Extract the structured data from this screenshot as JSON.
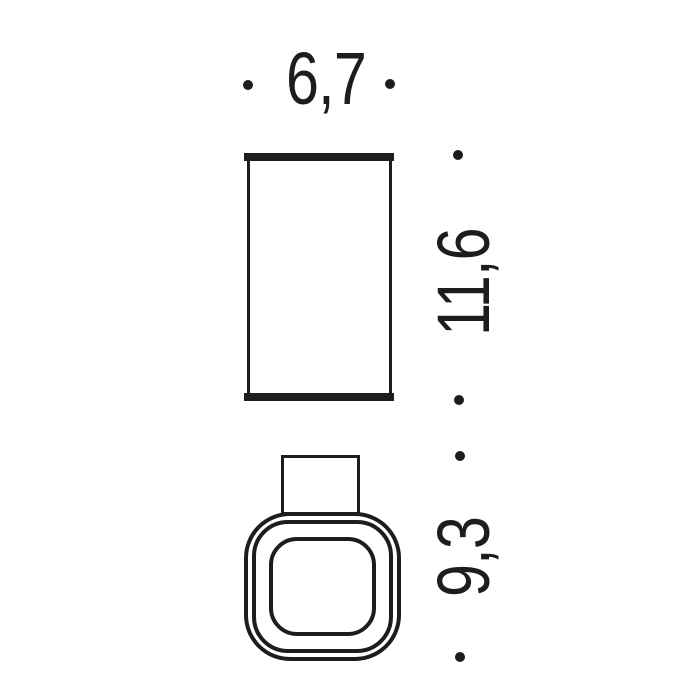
{
  "page": {
    "background_color": "#ffffff",
    "line_color": "#1d1d1b"
  },
  "drawing": {
    "type": "technical-dimension-drawing",
    "views": [
      {
        "name": "front-view",
        "shape": "rectangle with thick top and bottom rims"
      },
      {
        "name": "top-view",
        "shape": "rounded square with three concentric outlines and rectangular neck"
      }
    ],
    "dimensions": {
      "width": {
        "label": "6,7",
        "orientation": "horizontal"
      },
      "height": {
        "label": "11,6",
        "orientation": "vertical"
      },
      "depth": {
        "label": "9,3",
        "orientation": "vertical"
      }
    }
  }
}
